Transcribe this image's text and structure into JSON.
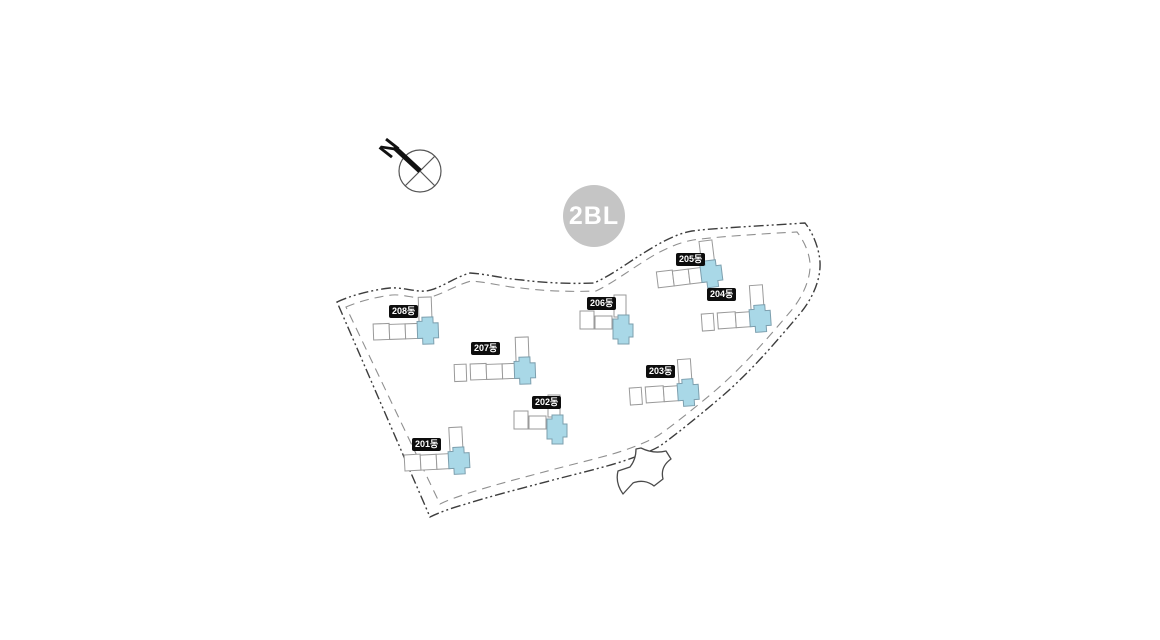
{
  "page": {
    "background": "#ffffff"
  },
  "block_badge": {
    "label": "2BL",
    "bg_color": "#c5c5c5",
    "text_color": "#ffffff"
  },
  "compass": {
    "north_label": "N"
  },
  "colors": {
    "boundary_outer": "#3d3d3d",
    "boundary_inner": "#8f8f8f",
    "building_outline": "#9a9a9a",
    "building_fill": "#ffffff",
    "core_fill": "#a9d8e7",
    "core_outline": "#7d9fae",
    "label_bg": "#0d0d0d",
    "label_text": "#ffffff",
    "compass_stroke": "#555555",
    "needle_color": "#111111",
    "entrance_outline": "#4a4a4a"
  },
  "buildings": [
    {
      "id": "201",
      "label": "201동",
      "label_x": 412,
      "label_y": 438,
      "x": 404,
      "y": 452,
      "rot": -3,
      "variant": "long",
      "units": 3,
      "annex": false
    },
    {
      "id": "202",
      "label": "202동",
      "label_x": 532,
      "label_y": 396,
      "x": 514,
      "y": 409,
      "rot": 0,
      "variant": "short"
    },
    {
      "id": "203",
      "label": "203동",
      "label_x": 646,
      "label_y": 365,
      "x": 645,
      "y": 384,
      "rot": -4,
      "variant": "long",
      "units": 2,
      "annex": true
    },
    {
      "id": "204",
      "label": "204동",
      "label_x": 707,
      "label_y": 288,
      "x": 717,
      "y": 310,
      "rot": -4,
      "variant": "long",
      "units": 2,
      "annex": true
    },
    {
      "id": "205",
      "label": "205동",
      "label_x": 676,
      "label_y": 253,
      "x": 656,
      "y": 269,
      "rot": -7,
      "variant": "long",
      "units": 3,
      "annex": false
    },
    {
      "id": "206",
      "label": "206동",
      "label_x": 587,
      "label_y": 297,
      "x": 580,
      "y": 309,
      "rot": 0,
      "variant": "short"
    },
    {
      "id": "207",
      "label": "207동",
      "label_x": 471,
      "label_y": 342,
      "x": 470,
      "y": 361,
      "rot": -2,
      "variant": "long",
      "units": 3,
      "annex": true
    },
    {
      "id": "208",
      "label": "208동",
      "label_x": 389,
      "label_y": 305,
      "x": 373,
      "y": 321,
      "rot": -2,
      "variant": "long",
      "units": 3,
      "annex": false
    }
  ]
}
